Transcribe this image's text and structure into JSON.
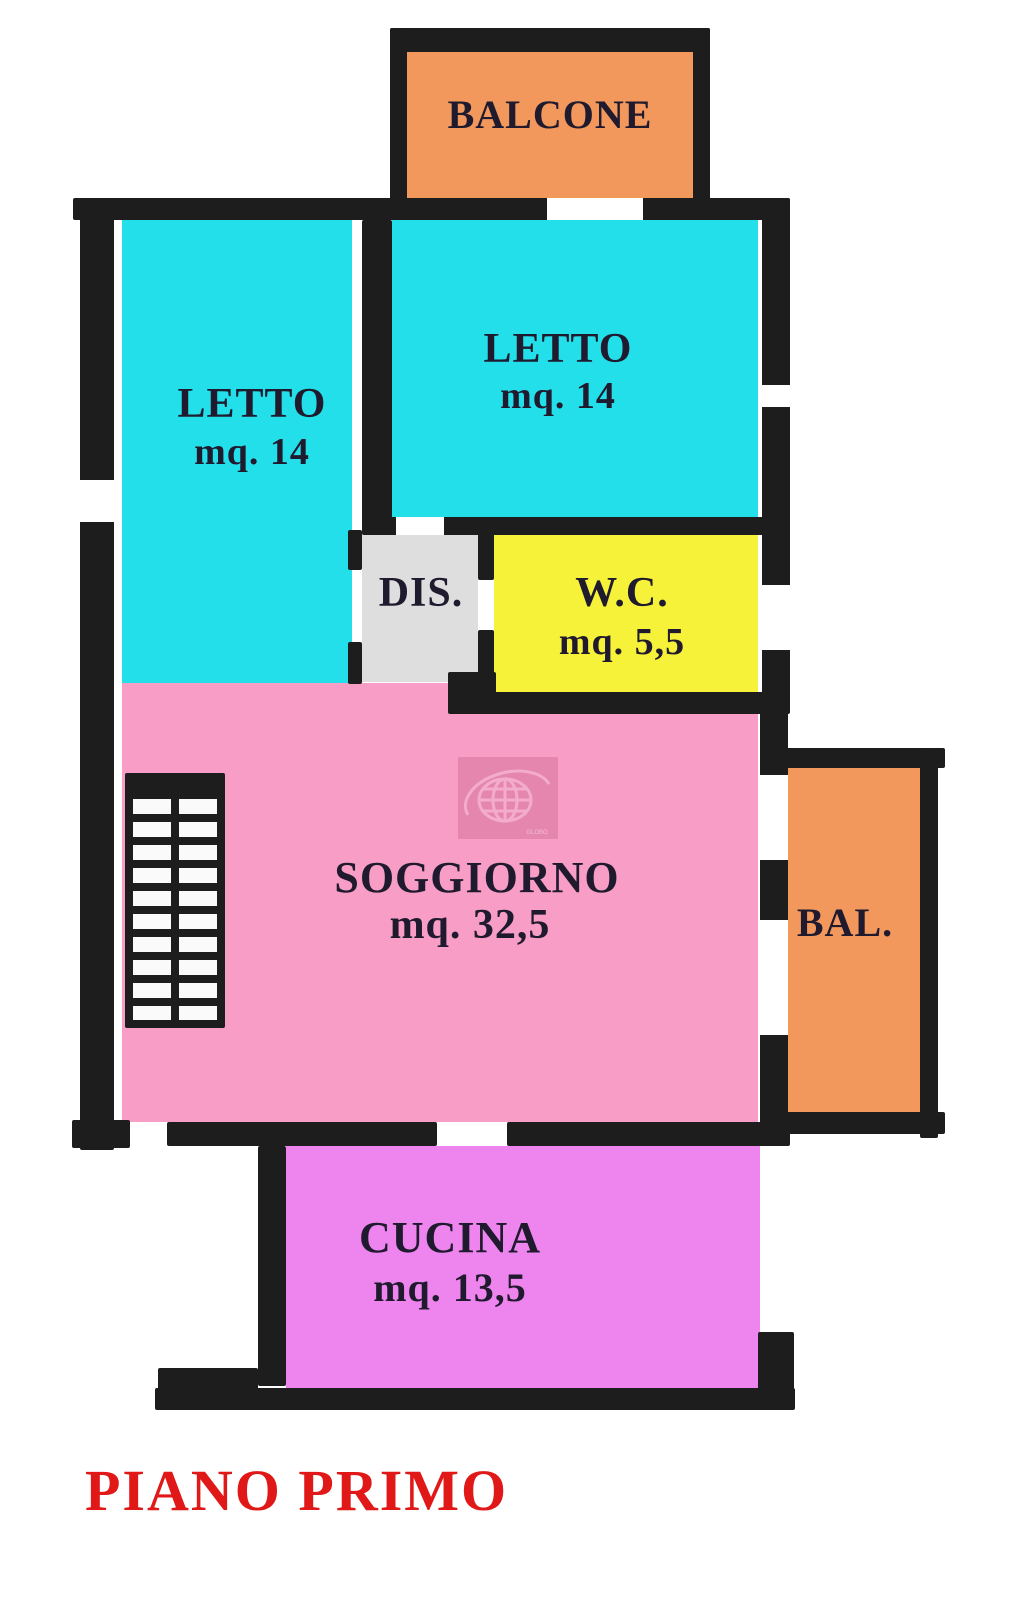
{
  "floor_title": {
    "text": "PIANO PRIMO",
    "color": "#e01818"
  },
  "watermark": {
    "text": "GLOBO"
  },
  "wall_color": "#1d1d1d",
  "rooms": {
    "balcone": {
      "label": "BALCONE",
      "color": "#f2985c"
    },
    "letto_sinistra": {
      "label": "LETTO",
      "area": "mq. 14",
      "color": "#22dfe9"
    },
    "letto_destra": {
      "label": "LETTO",
      "area": "mq. 14",
      "color": "#22dfe9"
    },
    "disimpegno": {
      "label": "DIS.",
      "color": "#dedede"
    },
    "wc": {
      "label": "W.C.",
      "area": "mq. 5,5",
      "color": "#f6f23a"
    },
    "soggiorno": {
      "label": "SOGGIORNO",
      "area": "mq. 32,5",
      "color": "#f79dc6"
    },
    "balcone_laterale": {
      "label": "BAL.",
      "color": "#f2985c"
    },
    "cucina": {
      "label": "CUCINA",
      "area": "mq. 13,5",
      "color": "#ee85ee"
    }
  }
}
